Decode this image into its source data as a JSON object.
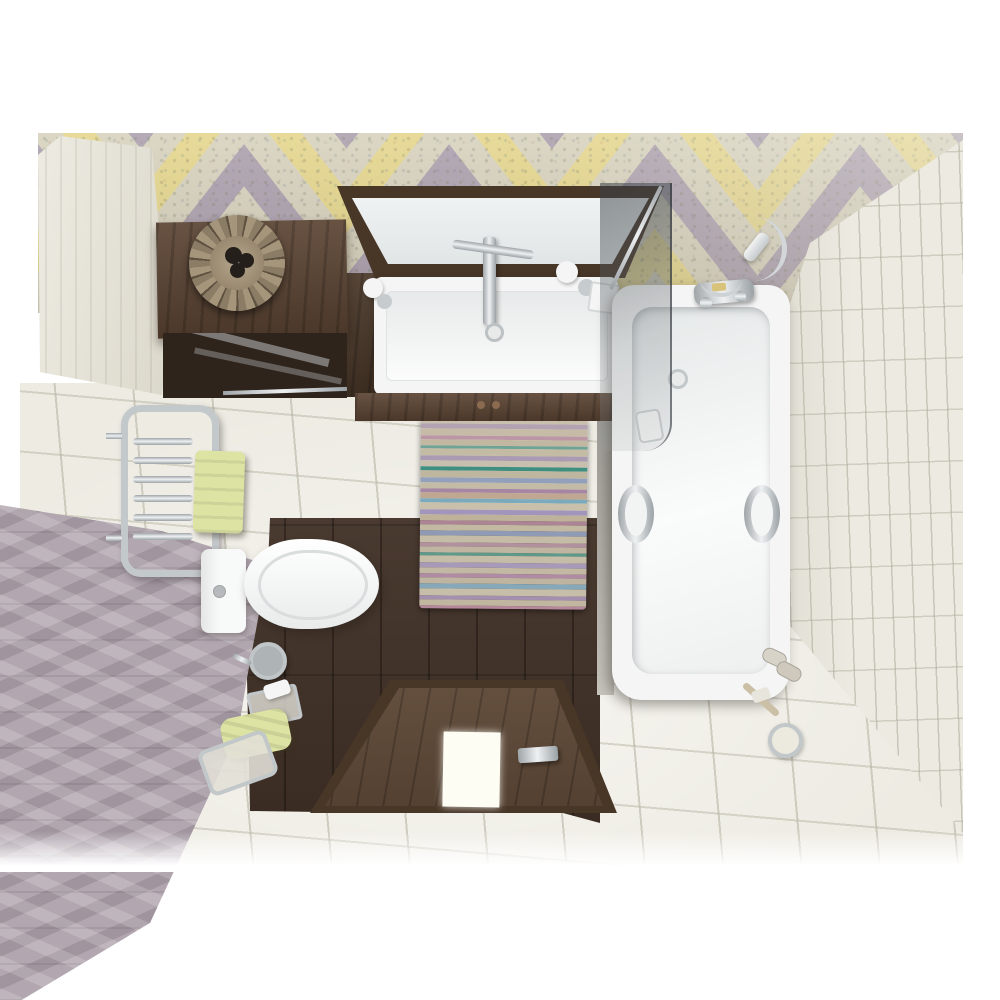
{
  "scene": {
    "description": "Top-down 3D render of a small bathroom",
    "objects": [
      "chevron-accent-wall",
      "cream-tile-wall",
      "lilac-herringbone-wall",
      "white-subway-tile-wall",
      "white-tile-floor",
      "dark-wood-floor",
      "striped-rug",
      "vanity-mirror",
      "vanity-sink",
      "vanity-cabinet",
      "wall-shelf",
      "wicker-basket",
      "glass-shelf",
      "towel-radiator",
      "radiator-towel",
      "toilet",
      "toilet-brush",
      "floor-towel",
      "bathroom-scale",
      "towel-rack",
      "bathtub",
      "tub-grab-handles",
      "shower-mixer",
      "shower-hose",
      "shower-handset",
      "glass-shower-screen",
      "soap-dish",
      "open-door",
      "door-glass-insert",
      "door-handle",
      "slippers",
      "bath-brush"
    ]
  },
  "palette": {
    "page_bg": "#ffffff",
    "scene_bg": "#e8e5dc",
    "cream_wall": "#e9e6da",
    "lilac_wall": "#b2a7b0",
    "white_wall": "#edeae1",
    "floor_tile": "#edebe2",
    "wood_dark": "#46352a",
    "wood_cabinet": "#5b4433",
    "wood_door": "#5e4836",
    "wood_frame": "#483627",
    "fixture_white": "#f4f5f4",
    "mirror_glass": "#e9edee",
    "chrome": "#c6cbce",
    "towel_green": "#dce3a3",
    "basket_tan": "#a3937a",
    "basket_dark": "#241f1b",
    "grey_strip": "#a5a39c",
    "door_insert": "#fdfdf4",
    "knob_brass": "#8a6b4f"
  },
  "chevron": {
    "columns": 9,
    "colors": {
      "yellow": "#e5d68c",
      "lilac": "#aba0ae",
      "patch": "#d7d2bd"
    }
  },
  "rug": {
    "stripes": [
      {
        "h": 6,
        "c": "#c8bfad"
      },
      {
        "h": 5,
        "c": "#b2a2b2"
      },
      {
        "h": 7,
        "c": "#c6bba6"
      },
      {
        "h": 4,
        "c": "#bb97a6"
      },
      {
        "h": 6,
        "c": "#c2b8a2"
      },
      {
        "h": 3,
        "c": "#6fa395"
      },
      {
        "h": 7,
        "c": "#c4bba5"
      },
      {
        "h": 5,
        "c": "#ab9bb2"
      },
      {
        "h": 6,
        "c": "#c8bfae"
      },
      {
        "h": 4,
        "c": "#3f8f81"
      },
      {
        "h": 7,
        "c": "#bfb6a0"
      },
      {
        "h": 5,
        "c": "#93a0bb"
      },
      {
        "h": 6,
        "c": "#c4bba6"
      },
      {
        "h": 4,
        "c": "#a786a3"
      },
      {
        "h": 6,
        "c": "#bfa792"
      },
      {
        "h": 4,
        "c": "#7aaabc"
      },
      {
        "h": 7,
        "c": "#c8c0ab"
      },
      {
        "h": 5,
        "c": "#a295bb"
      },
      {
        "h": 6,
        "c": "#beb29b"
      },
      {
        "h": 4,
        "c": "#ad8495"
      },
      {
        "h": 6,
        "c": "#c3b9a3"
      },
      {
        "h": 5,
        "c": "#8f9ab5"
      },
      {
        "h": 7,
        "c": "#c5bca7"
      },
      {
        "h": 4,
        "c": "#b2919f"
      },
      {
        "h": 6,
        "c": "#c0b5a0"
      },
      {
        "h": 3,
        "c": "#5e9a8c"
      },
      {
        "h": 7,
        "c": "#c6bda8"
      },
      {
        "h": 5,
        "c": "#a79ab8"
      },
      {
        "h": 6,
        "c": "#c2b8a3"
      },
      {
        "h": 4,
        "c": "#b08ba4"
      },
      {
        "h": 6,
        "c": "#bfb49f"
      },
      {
        "h": 5,
        "c": "#86a8b8"
      },
      {
        "h": 7,
        "c": "#c7bea9"
      },
      {
        "h": 4,
        "c": "#a48fae"
      },
      {
        "h": 6,
        "c": "#c1b7a1"
      },
      {
        "h": 3,
        "c": "#b5899b"
      }
    ]
  }
}
